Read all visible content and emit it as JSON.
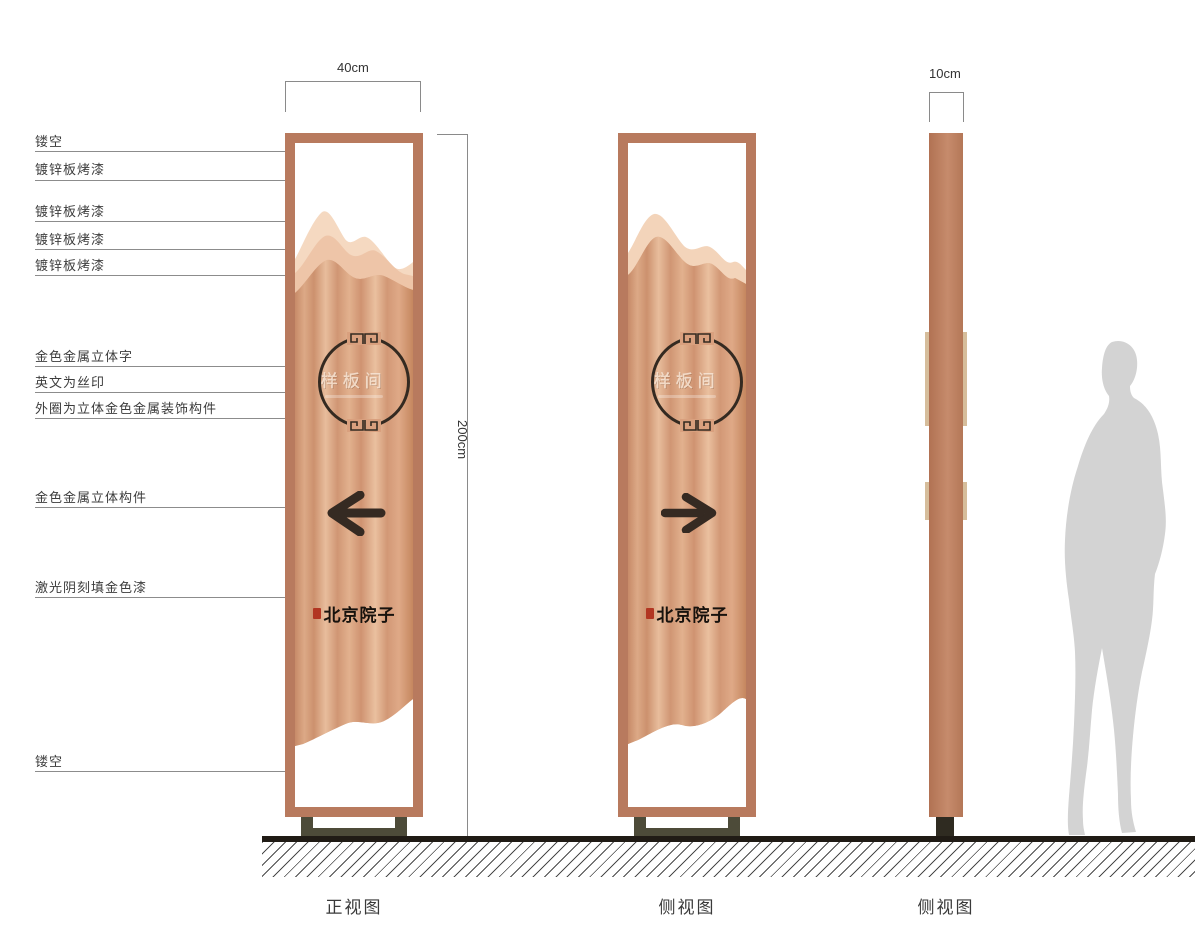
{
  "callouts": [
    {
      "text": "镂空"
    },
    {
      "text": "镀锌板烤漆"
    },
    {
      "text": "镀锌板烤漆"
    },
    {
      "text": "镀锌板烤漆"
    },
    {
      "text": "镀锌板烤漆"
    },
    {
      "text": "金色金属立体字"
    },
    {
      "text": "英文为丝印"
    },
    {
      "text": "外圈为立体金色金属装饰构件"
    },
    {
      "text": "金色金属立体构件"
    },
    {
      "text": "激光阴刻填金色漆"
    },
    {
      "text": "镂空"
    }
  ],
  "dimensions": {
    "front_width": "40cm",
    "height": "200cm",
    "side_depth": "10cm"
  },
  "sign": {
    "room_name": "样板间",
    "brand_name": "北京院子"
  },
  "view_labels": {
    "front": "正视图",
    "side": "侧视图",
    "profile": "侧视图"
  },
  "colors": {
    "frame_copper": "#b87a5e",
    "panel_light_mountain": "#f5d9c1",
    "panel_mid_mountain": "#eec5a8",
    "panel_copper_base": "#d59a78",
    "ink_dark": "#342a21",
    "seal_red": "#b23622",
    "stand_olive": "#4d4b39",
    "ground_black": "#201b15",
    "silhouette_gray": "#d3d3d3"
  }
}
